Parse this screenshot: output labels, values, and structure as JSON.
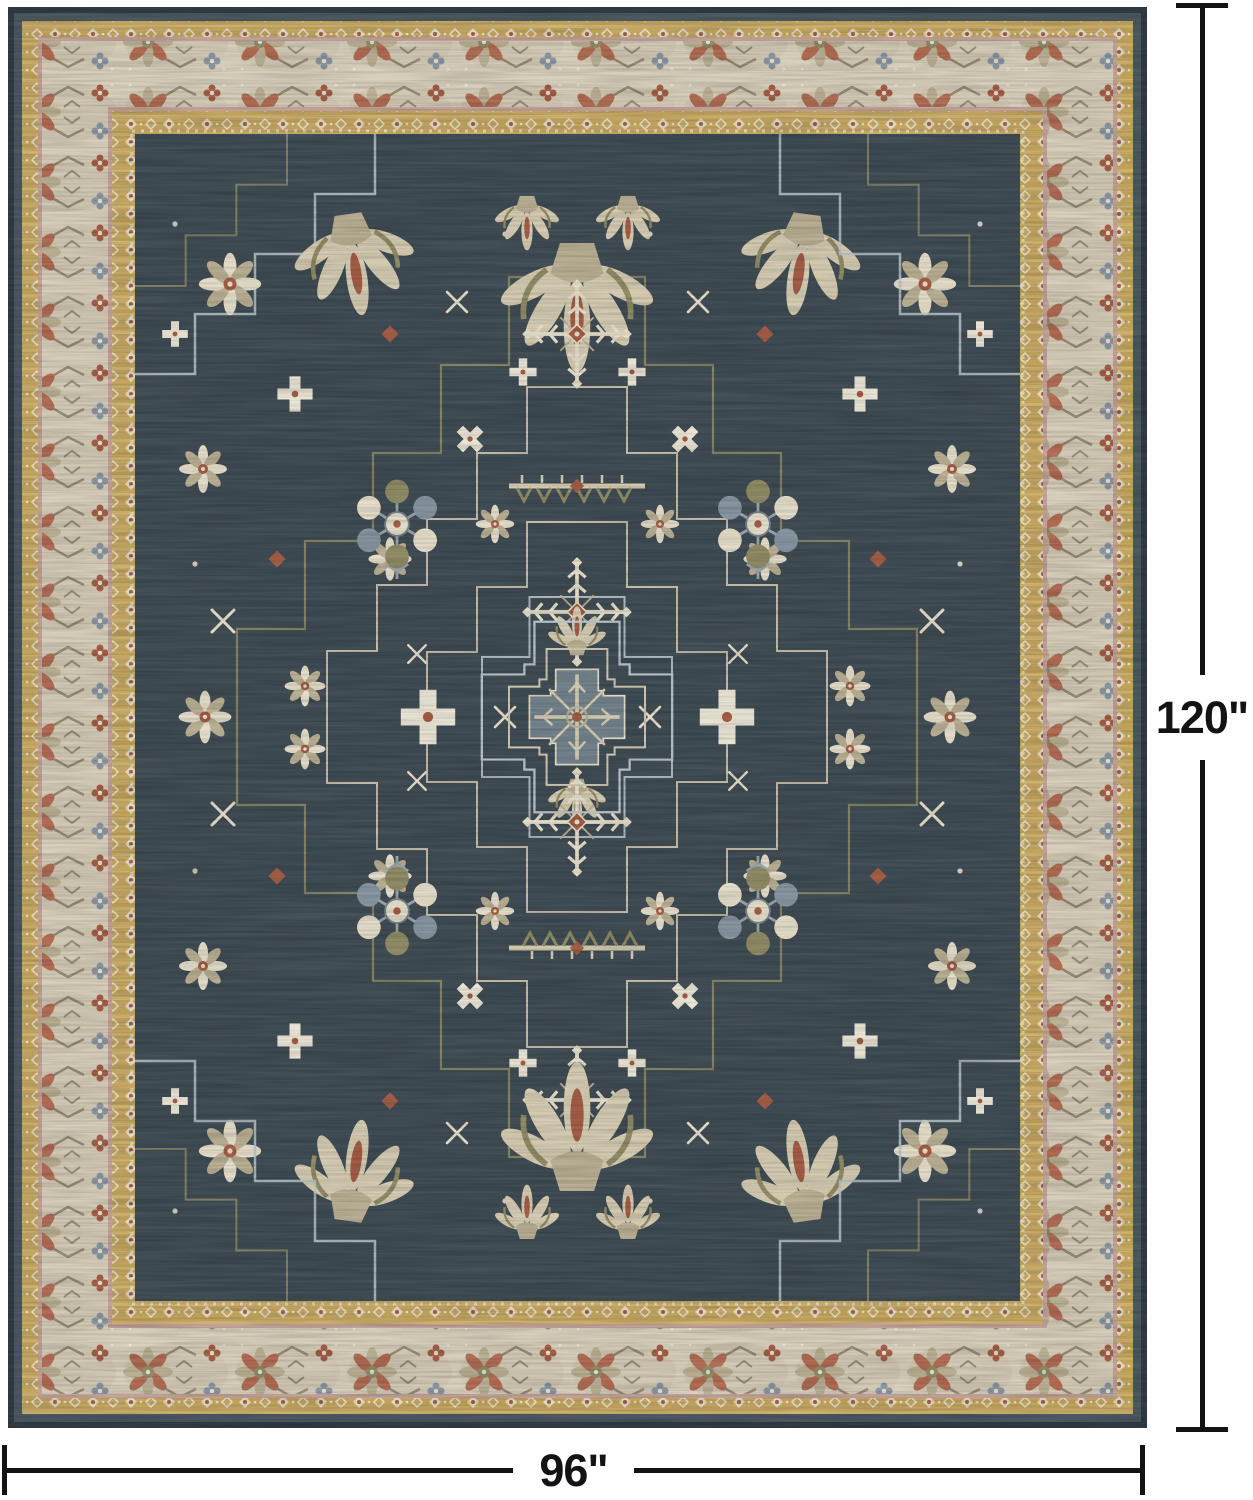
{
  "page": {
    "background": "#ffffff",
    "description": "Product image of a vintage distressed Persian-style medallion area rug shown flat with black size dimension lines"
  },
  "rug": {
    "style_name": "vintage medallion area rug",
    "field_color": "#3e4a52",
    "outer_band_color": "#4a565e",
    "gold_band_color": "#c3a45e",
    "gold_band_light_color": "#d6bd80",
    "cream_border_color": "#d7cfbb",
    "accent_line_color": "#c2a198",
    "ivory_motif_color": "#e4ddc9",
    "cream_motif_color": "#d3cab0",
    "tan_motif_color": "#b8ae92",
    "olive_motif_color": "#8e8a64",
    "rust_motif_color": "#a25b44",
    "grey_blue_motif_color": "#8694a0",
    "medallion_fill_color": "#72818b",
    "outline_cream_color": "#cfc7b0",
    "outline_olive_color": "#8a8868",
    "outline_white_color": "#b9c4c8"
  },
  "annotations": {
    "line_color": "#131313",
    "height_label": "120\"",
    "width_label": "96\""
  }
}
